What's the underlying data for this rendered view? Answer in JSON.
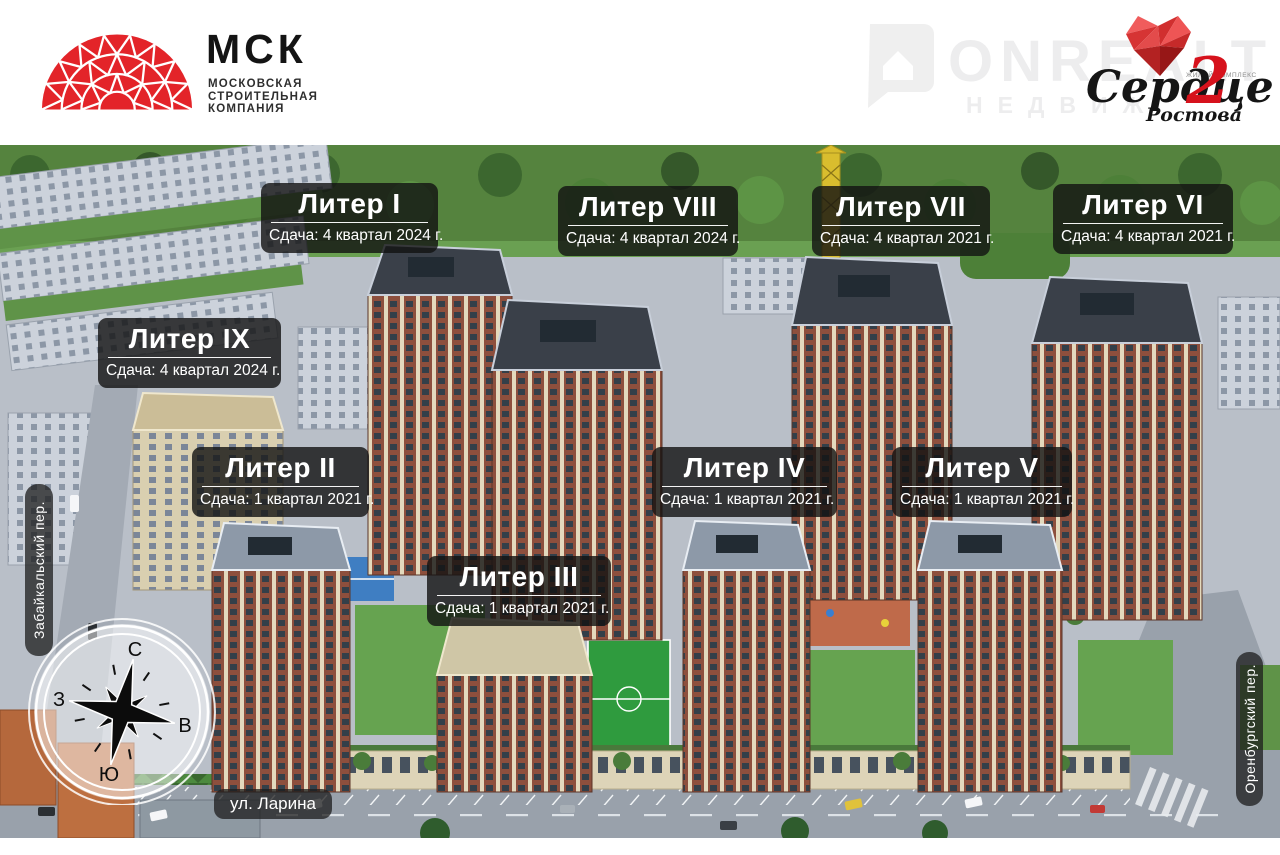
{
  "header": {
    "msk_logo": {
      "abbr": "МСК",
      "name_lines": [
        "МОСКОВСКАЯ",
        "СТРОИТЕЛЬНАЯ",
        "КОМПАНИЯ"
      ],
      "brand_red": "#e32429"
    },
    "watermark": {
      "brand": "ONREALT",
      "sub": "НЕДВИЖ"
    },
    "complex_logo": {
      "label_small": "ЖИЛОЙ КОМПЛЕКС",
      "name_script": "Сердце",
      "number": "2",
      "city_script": "Ростова",
      "heart_red": "#d6121c"
    }
  },
  "site_plan": {
    "buildings": [
      {
        "name": "Литер I",
        "delivery": "Сдача: 4 квартал 2024 г."
      },
      {
        "name": "Литер VIII",
        "delivery": "Сдача: 4 квартал 2024 г."
      },
      {
        "name": "Литер VII",
        "delivery": "Сдача: 4 квартал 2021 г."
      },
      {
        "name": "Литер VI",
        "delivery": "Сдача: 4 квартал 2021 г."
      },
      {
        "name": "Литер IX",
        "delivery": "Сдача: 4 квартал 2024 г."
      },
      {
        "name": "Литер II",
        "delivery": "Сдача: 1 квартал 2021 г."
      },
      {
        "name": "Литер IV",
        "delivery": "Сдача: 1 квартал 2021 г."
      },
      {
        "name": "Литер V",
        "delivery": "Сдача: 1 квартал 2021 г."
      },
      {
        "name": "Литер III",
        "delivery": "Сдача: 1 квартал 2021 г."
      }
    ],
    "streets": {
      "left": "Забайкальский пер.",
      "right": "Оренбургский пер.",
      "bottom": "ул. Ларина"
    },
    "compass": {
      "north": "С",
      "south": "Ю",
      "west": "З",
      "east": "В"
    },
    "colors": {
      "plate_bg": "#121212",
      "plate_text": "#ffffff",
      "brick": "#8d4f3d",
      "lawn": "#66a350"
    }
  }
}
